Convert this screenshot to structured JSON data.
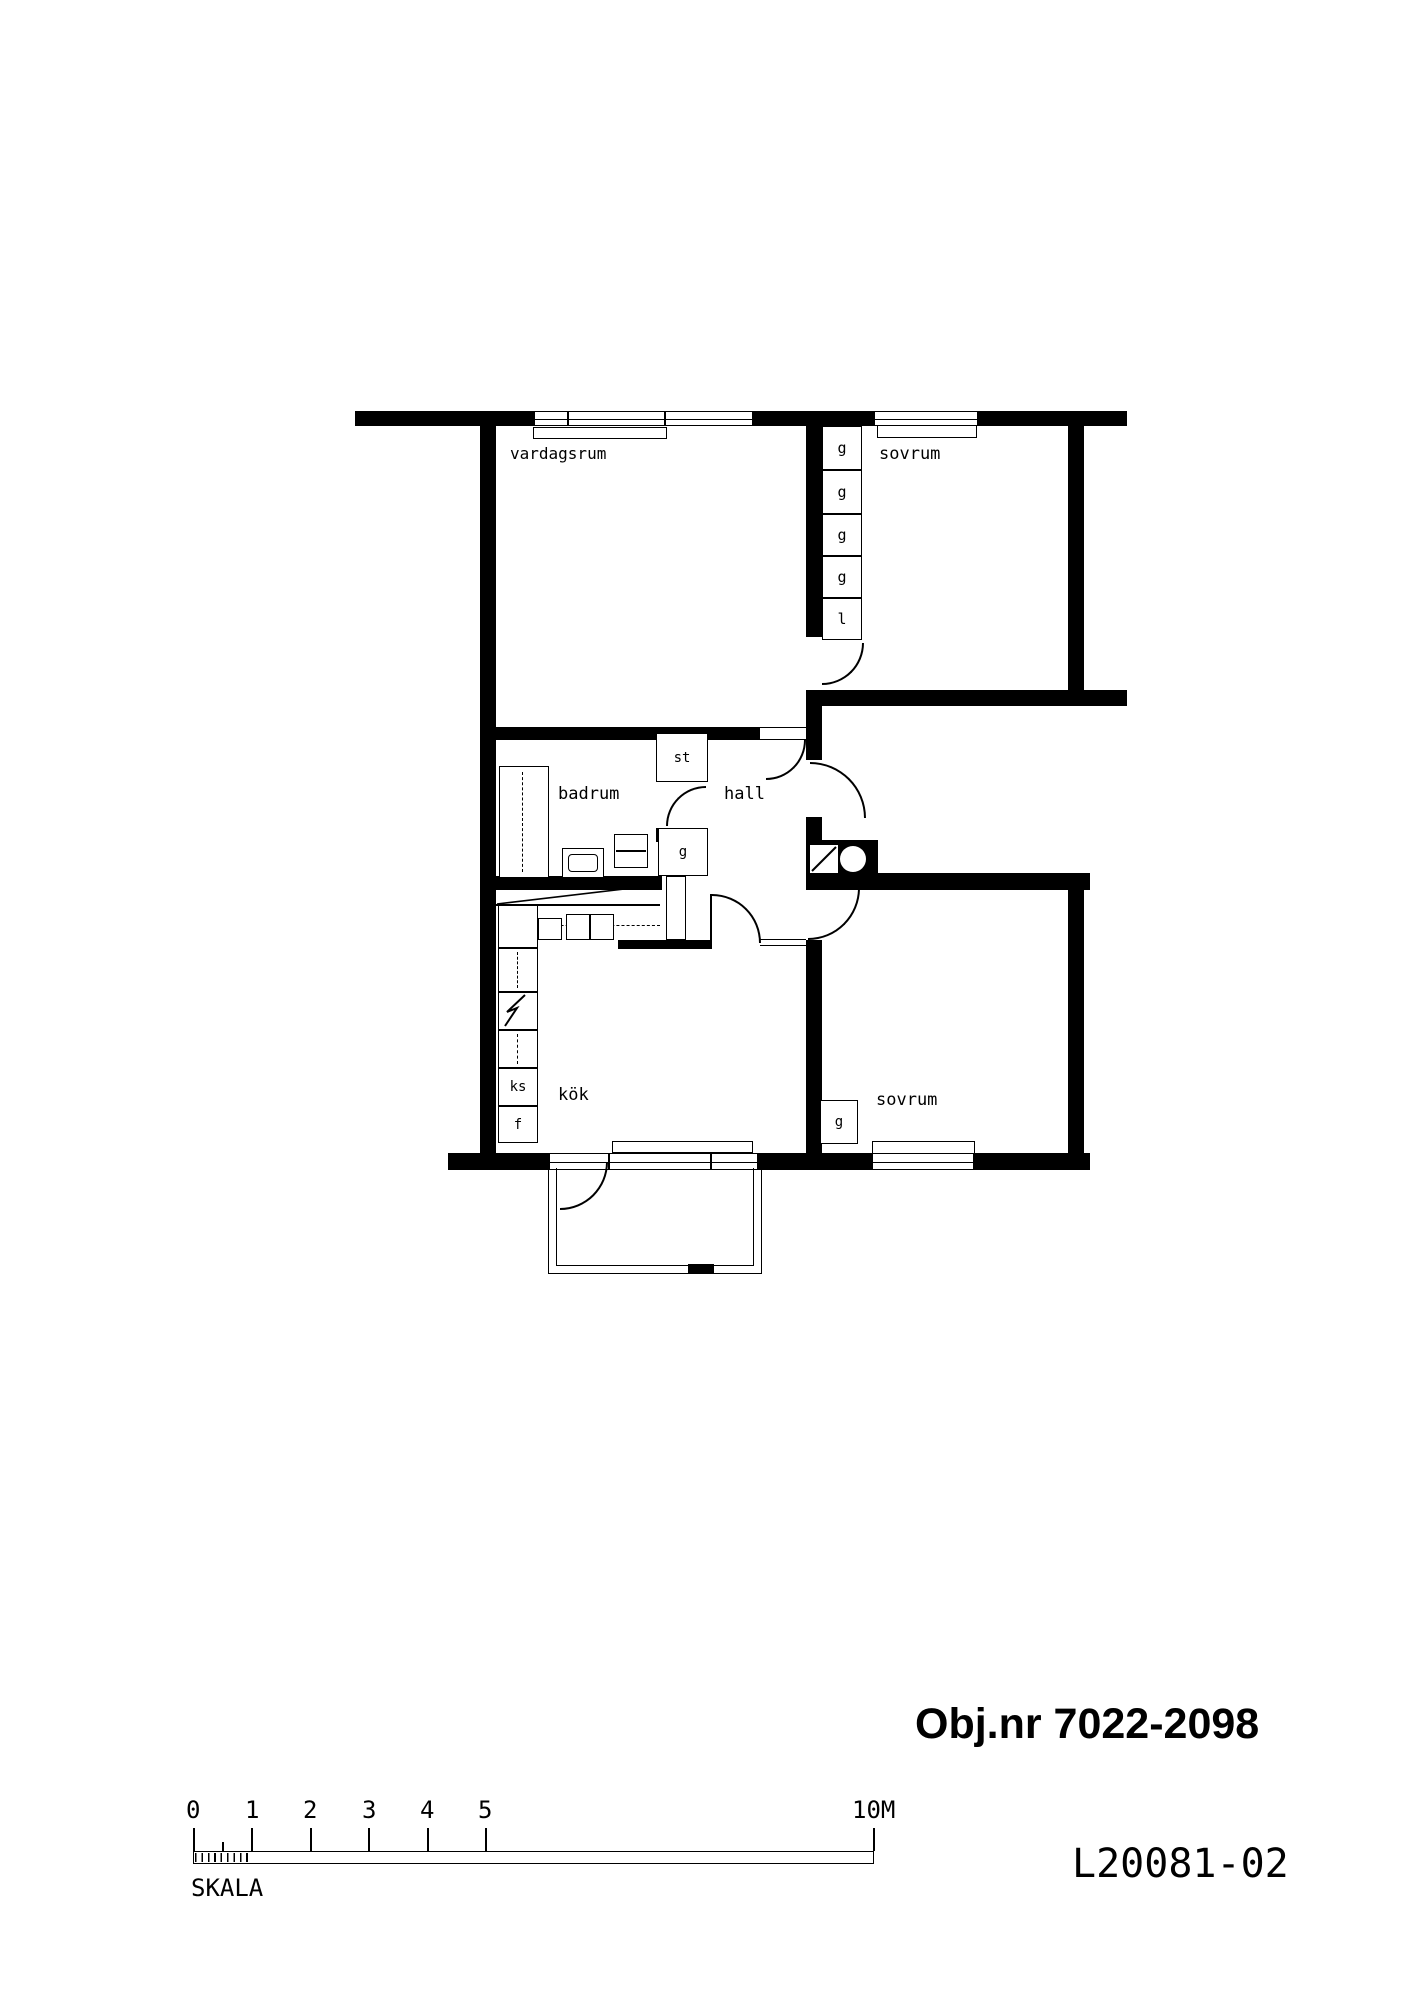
{
  "plan": {
    "rooms": {
      "living_room": "vardagsrum",
      "bedroom_top": "sovrum",
      "bedroom_bottom": "sovrum",
      "bathroom": "badrum",
      "hall": "hall",
      "kitchen": "kök"
    },
    "closets": {
      "wardrobe_column": [
        "g",
        "g",
        "g",
        "g",
        "l"
      ],
      "cleaning_closet": "st",
      "hall_wardrobe": "g",
      "bedroom_wardrobe": "g",
      "fridge": "ks",
      "freezer": "f"
    }
  },
  "annotations": {
    "object_number": "Obj.nr 7022-2098",
    "drawing_number": "L20081-02",
    "scale_caption": "SKALA"
  },
  "scale_bar": {
    "tick_labels": [
      "0",
      "1",
      "2",
      "3",
      "4",
      "5"
    ],
    "end_label": "10M"
  },
  "colors": {
    "ink": "#000000",
    "paper": "#ffffff"
  }
}
